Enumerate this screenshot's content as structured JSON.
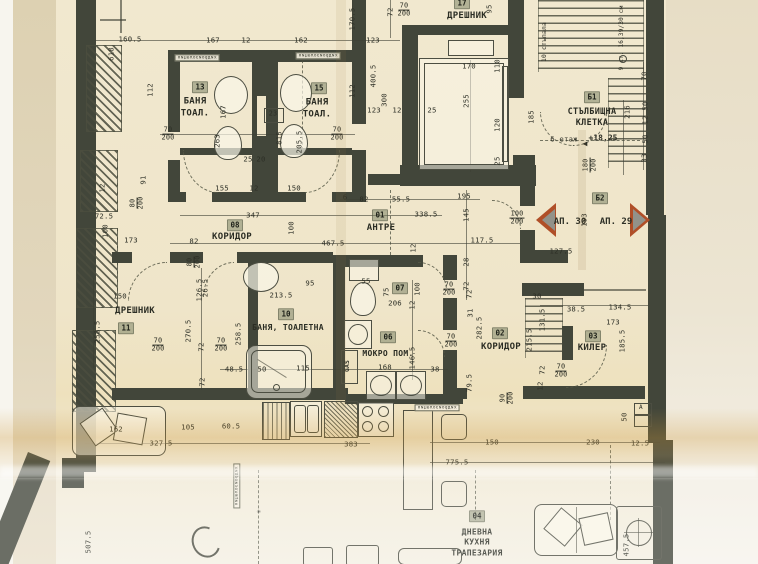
{
  "plan": {
    "rooms": [
      {
        "num": "13",
        "name": "БАНЯ\nТОАЛ."
      },
      {
        "num": "15",
        "name": "БАНЯ\nТОАЛ."
      },
      {
        "num": "17",
        "name": "ДРЕШНИК"
      },
      {
        "num": "01",
        "name": "АНТРЕ"
      },
      {
        "num": "08",
        "name": "КОРИДОР"
      },
      {
        "num": "11",
        "name": "ДРЕШНИК"
      },
      {
        "num": "10",
        "name": "БАНЯ, ТОАЛЕТНА"
      },
      {
        "num": "07",
        "name": ""
      },
      {
        "num": "06",
        "name": "МОКРО ПОМ."
      },
      {
        "num": "02",
        "name": "КОРИДОР"
      },
      {
        "num": "03",
        "name": "КИЛЕР"
      },
      {
        "num": "04",
        "name": "ДНЕВНА\nКУХНЯ\nТРАПЕЗАРИЯ"
      },
      {
        "num": "Б1",
        "name": "СТЪЛБИЩНА\nКЛЕТКА"
      },
      {
        "num": "Б2",
        "name": ""
      }
    ],
    "apartment_left": "АП. 30",
    "apartment_right": "АП. 29",
    "floor_note": "6 етаж",
    "level_mark": "+18,25",
    "direction_arrow": "◀",
    "stair_text_top": "10 стъпала",
    "stair_text_right": "9 ст. 16,39/30 см",
    "gas_label": "GAS",
    "shaft_label": "23",
    "letter_box": "А",
    "waterproof_strip": "хидроизолация",
    "strips": [
      {
        "x": 197,
        "y": 58
      },
      {
        "x": 318,
        "y": 56
      },
      {
        "x": 437,
        "y": 408
      },
      {
        "x": 237,
        "y": 486,
        "r": -90
      }
    ],
    "annotations": [
      {
        "t": "160.5",
        "x": 130,
        "y": 39
      },
      {
        "t": "167",
        "x": 213,
        "y": 40
      },
      {
        "t": "12",
        "x": 246,
        "y": 40
      },
      {
        "t": "162",
        "x": 301,
        "y": 40
      },
      {
        "t": "123",
        "x": 373,
        "y": 40
      },
      {
        "t": "170",
        "x": 469,
        "y": 66
      },
      {
        "t": "155",
        "x": 222,
        "y": 188
      },
      {
        "t": "12",
        "x": 254,
        "y": 188
      },
      {
        "t": "150",
        "x": 294,
        "y": 188
      },
      {
        "t": "25",
        "x": 248,
        "y": 159
      },
      {
        "t": "20",
        "x": 261,
        "y": 159
      },
      {
        "t": "347",
        "x": 253,
        "y": 215
      },
      {
        "t": "82",
        "x": 194,
        "y": 241
      },
      {
        "t": "467.5",
        "x": 333,
        "y": 243
      },
      {
        "t": "6",
        "x": 345,
        "y": 197
      },
      {
        "t": "82",
        "x": 364,
        "y": 199
      },
      {
        "t": "55.5",
        "x": 401,
        "y": 199
      },
      {
        "t": "195",
        "x": 464,
        "y": 196
      },
      {
        "t": "338.5",
        "x": 426,
        "y": 214
      },
      {
        "t": "117.5",
        "x": 482,
        "y": 240
      },
      {
        "t": "127.5",
        "x": 561,
        "y": 251
      },
      {
        "t": "150",
        "x": 120,
        "y": 296
      },
      {
        "t": "213.5",
        "x": 281,
        "y": 295
      },
      {
        "t": "206",
        "x": 395,
        "y": 303
      },
      {
        "t": "95",
        "x": 310,
        "y": 283
      },
      {
        "t": "55",
        "x": 366,
        "y": 281
      },
      {
        "t": "48.5",
        "x": 234,
        "y": 369
      },
      {
        "t": "50",
        "x": 262,
        "y": 369
      },
      {
        "t": "115",
        "x": 303,
        "y": 368
      },
      {
        "t": "168",
        "x": 385,
        "y": 367
      },
      {
        "t": "38",
        "x": 435,
        "y": 369
      },
      {
        "t": "30",
        "x": 537,
        "y": 296
      },
      {
        "t": "38.5",
        "x": 576,
        "y": 309
      },
      {
        "t": "134.5",
        "x": 620,
        "y": 307
      },
      {
        "t": "173",
        "x": 613,
        "y": 322
      },
      {
        "t": "72.5",
        "x": 104,
        "y": 216
      },
      {
        "t": "173",
        "x": 131,
        "y": 240
      },
      {
        "t": "123",
        "x": 374,
        "y": 110
      },
      {
        "t": "12",
        "x": 397,
        "y": 110
      },
      {
        "t": "25",
        "x": 432,
        "y": 110
      },
      {
        "t": "162",
        "x": 116,
        "y": 429
      },
      {
        "t": "327.5",
        "x": 161,
        "y": 443
      },
      {
        "t": "105",
        "x": 188,
        "y": 427
      },
      {
        "t": "60.5",
        "x": 231,
        "y": 426
      },
      {
        "t": "383",
        "x": 351,
        "y": 444
      },
      {
        "t": "775.5",
        "x": 457,
        "y": 462
      },
      {
        "t": "150",
        "x": 492,
        "y": 442
      },
      {
        "t": "230",
        "x": 593,
        "y": 442
      },
      {
        "t": "12.5",
        "x": 640,
        "y": 443
      },
      {
        "t": "✳",
        "x": 259,
        "y": 511
      },
      {
        "t": "170.5",
        "x": 352,
        "y": 19,
        "r": -90
      },
      {
        "t": "72",
        "x": 390,
        "y": 12,
        "r": -90
      },
      {
        "t": "95",
        "x": 489,
        "y": 9,
        "r": -90
      },
      {
        "t": "112",
        "x": 150,
        "y": 90,
        "r": -90
      },
      {
        "t": "618",
        "x": 111,
        "y": 54,
        "r": -90
      },
      {
        "t": "400.5",
        "x": 373,
        "y": 76,
        "r": -90
      },
      {
        "t": "112",
        "x": 352,
        "y": 91,
        "r": -90
      },
      {
        "t": "300",
        "x": 384,
        "y": 100,
        "r": -90
      },
      {
        "t": "167",
        "x": 223,
        "y": 112,
        "r": -90
      },
      {
        "t": "263",
        "x": 217,
        "y": 141,
        "r": -90
      },
      {
        "t": "815",
        "x": 279,
        "y": 138,
        "r": -90
      },
      {
        "t": "205.5",
        "x": 299,
        "y": 142,
        "r": -90
      },
      {
        "t": "110",
        "x": 497,
        "y": 66,
        "r": -90
      },
      {
        "t": "255",
        "x": 466,
        "y": 101,
        "r": -90
      },
      {
        "t": "120",
        "x": 497,
        "y": 125,
        "r": -90
      },
      {
        "t": "185",
        "x": 531,
        "y": 117,
        "r": -90
      },
      {
        "t": "25",
        "x": 497,
        "y": 161,
        "r": -90
      },
      {
        "t": "216",
        "x": 627,
        "y": 112,
        "r": -90
      },
      {
        "t": "70",
        "x": 644,
        "y": 76,
        "r": -90
      },
      {
        "t": "50",
        "x": 645,
        "y": 106,
        "r": -90
      },
      {
        "t": "12",
        "x": 645,
        "y": 120,
        "r": -90
      },
      {
        "t": "50",
        "x": 645,
        "y": 139,
        "r": -90
      },
      {
        "t": "33",
        "x": 644,
        "y": 158,
        "r": -90
      },
      {
        "t": "100",
        "x": 291,
        "y": 228,
        "r": -90
      },
      {
        "t": "145",
        "x": 466,
        "y": 215,
        "r": -90
      },
      {
        "t": "12",
        "x": 413,
        "y": 248,
        "r": -90
      },
      {
        "t": "28",
        "x": 466,
        "y": 262,
        "r": -90
      },
      {
        "t": "72",
        "x": 466,
        "y": 286,
        "r": -90
      },
      {
        "t": "126.5",
        "x": 199,
        "y": 290,
        "r": -90
      },
      {
        "t": "270.5",
        "x": 188,
        "y": 331,
        "r": -90
      },
      {
        "t": "258.5",
        "x": 97,
        "y": 332,
        "r": -90
      },
      {
        "t": "258.5",
        "x": 238,
        "y": 334,
        "r": -90
      },
      {
        "t": "72",
        "x": 201,
        "y": 347,
        "r": -90
      },
      {
        "t": "72",
        "x": 202,
        "y": 382,
        "r": -90
      },
      {
        "t": "12",
        "x": 412,
        "y": 305,
        "r": -90
      },
      {
        "t": "146.5",
        "x": 412,
        "y": 358,
        "r": -90
      },
      {
        "t": "100",
        "x": 417,
        "y": 289,
        "r": -90
      },
      {
        "t": "75",
        "x": 386,
        "y": 292,
        "r": -90
      },
      {
        "t": "282.5",
        "x": 479,
        "y": 328,
        "r": -90
      },
      {
        "t": "72",
        "x": 469,
        "y": 294,
        "r": -90
      },
      {
        "t": "31",
        "x": 470,
        "y": 313,
        "r": -90
      },
      {
        "t": "79.5",
        "x": 469,
        "y": 383,
        "r": -90
      },
      {
        "t": "131.5",
        "x": 542,
        "y": 320,
        "r": -90
      },
      {
        "t": "215.5",
        "x": 529,
        "y": 340,
        "r": -90
      },
      {
        "t": "185.5",
        "x": 622,
        "y": 341,
        "r": -90
      },
      {
        "t": "72",
        "x": 542,
        "y": 370,
        "r": -90
      },
      {
        "t": "12",
        "x": 540,
        "y": 386,
        "r": -90
      },
      {
        "t": "507.5",
        "x": 88,
        "y": 542,
        "r": -90
      },
      {
        "t": "457.5",
        "x": 626,
        "y": 545,
        "r": -90
      },
      {
        "t": "50",
        "x": 624,
        "y": 417,
        "r": -90
      },
      {
        "t": "91",
        "x": 143,
        "y": 180,
        "r": -90
      },
      {
        "t": "100",
        "x": 105,
        "y": 231,
        "r": -90
      },
      {
        "t": "26.5",
        "x": 205,
        "y": 288,
        "r": -90
      },
      {
        "t": "12",
        "x": 102,
        "y": 188,
        "r": -90
      },
      {
        "t": "193",
        "x": 584,
        "y": 220,
        "r": -90
      },
      {
        "t": "70",
        "b": "200",
        "x": 168,
        "y": 134
      },
      {
        "t": "70",
        "b": "200",
        "x": 337,
        "y": 134
      },
      {
        "t": "70",
        "b": "200",
        "x": 404,
        "y": 10
      },
      {
        "t": "100",
        "b": "200",
        "x": 517,
        "y": 218
      },
      {
        "t": "70",
        "b": "200",
        "x": 158,
        "y": 345
      },
      {
        "t": "70",
        "b": "200",
        "x": 221,
        "y": 345
      },
      {
        "t": "70",
        "b": "200",
        "x": 449,
        "y": 289
      },
      {
        "t": "70",
        "b": "200",
        "x": 451,
        "y": 341
      },
      {
        "t": "70",
        "b": "200",
        "x": 561,
        "y": 371
      },
      {
        "t": "80",
        "b": "200",
        "x": 137,
        "y": 203,
        "r": -90
      },
      {
        "t": "80",
        "b": "200",
        "x": 194,
        "y": 262,
        "r": -90
      },
      {
        "t": "90",
        "b": "200",
        "x": 507,
        "y": 398,
        "r": -90
      },
      {
        "t": "180",
        "b": "200",
        "x": 590,
        "y": 165,
        "r": -90
      }
    ]
  },
  "colors": {
    "paper": "#f0e7cd",
    "wall": "#42463a",
    "ink": "#2d2f26",
    "badge_bg": "#7d8568",
    "marker_orange": "#b04f28",
    "marker_gray": "#92928a",
    "crease_amber": "#cd983c"
  }
}
